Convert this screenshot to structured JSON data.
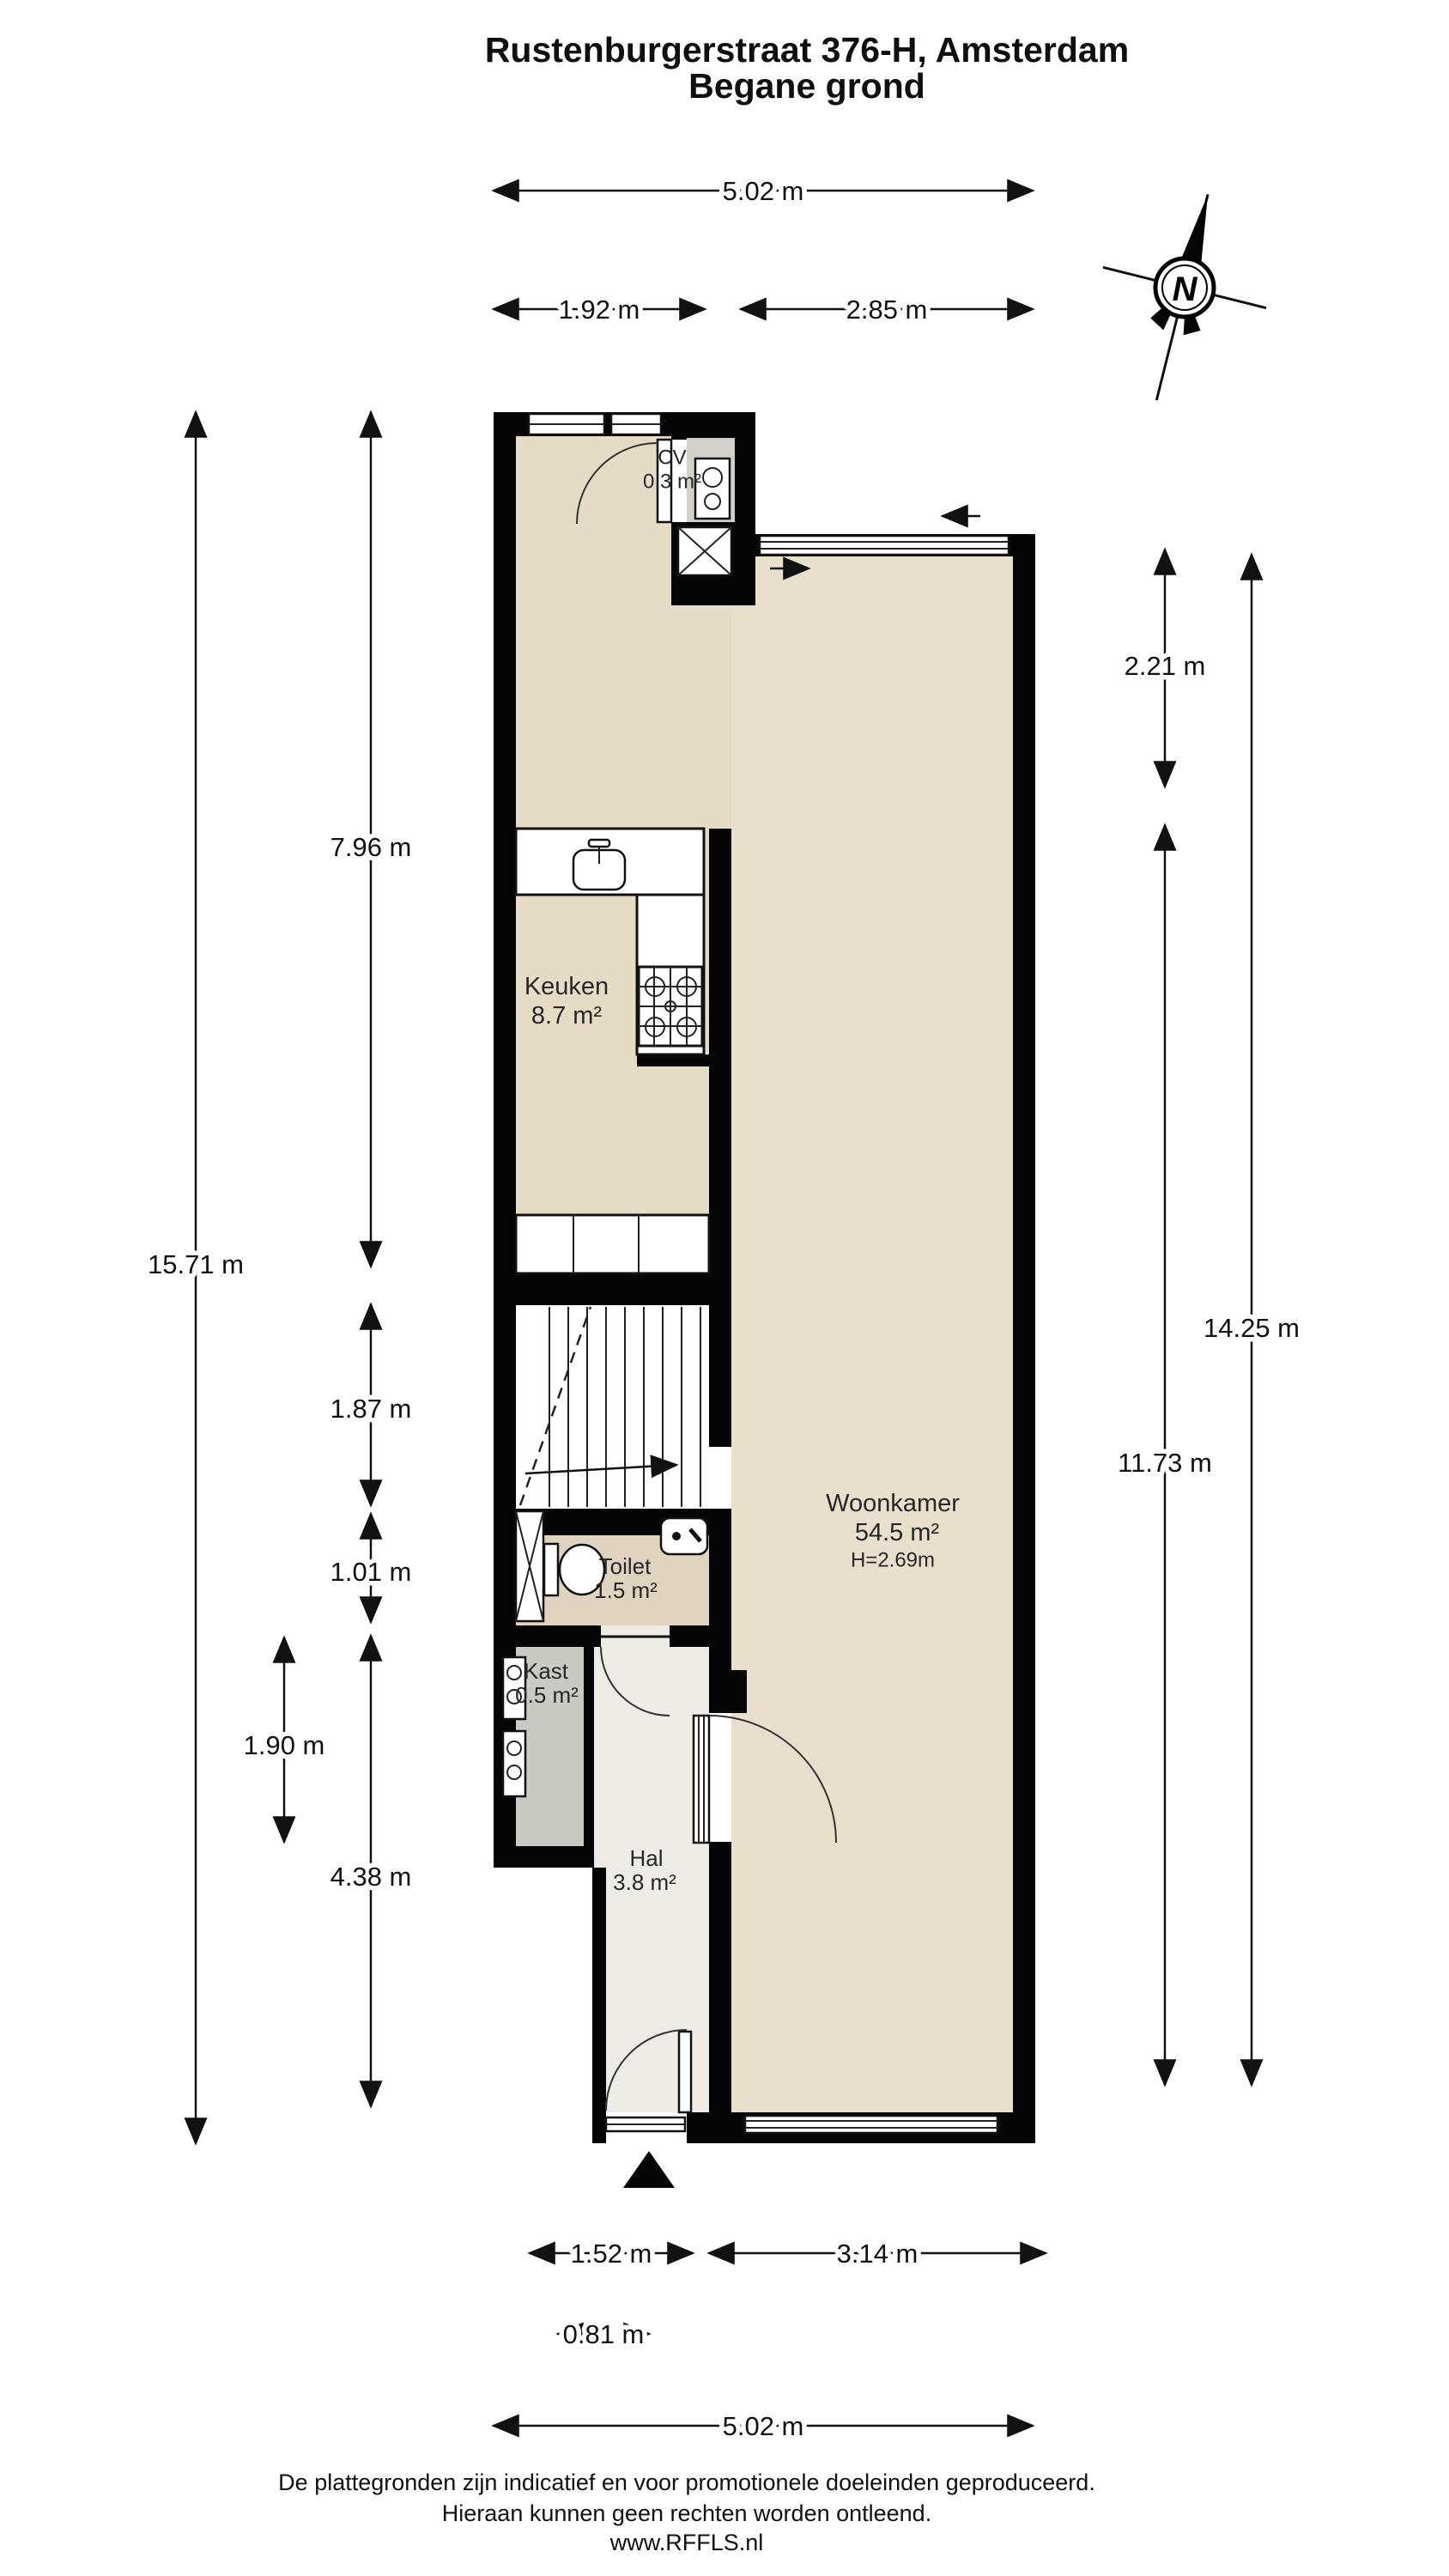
{
  "header": {
    "title_line1": "Rustenburgerstraat 376-H, Amsterdam",
    "title_line2": "Begane grond"
  },
  "compass": {
    "label": "N"
  },
  "rooms": {
    "cv": {
      "name": "CV",
      "area": "0.3 m²"
    },
    "keuken": {
      "name": "Keuken",
      "area": "8.7 m²"
    },
    "woonkamer": {
      "name": "Woonkamer",
      "area": "54.5 m²",
      "height": "H=2.69m"
    },
    "toilet": {
      "name": "Toilet",
      "area": "1.5 m²"
    },
    "kast": {
      "name": "Kast",
      "area": "0.5 m²"
    },
    "hal": {
      "name": "Hal",
      "area": "3.8 m²"
    }
  },
  "dimensions": {
    "top_total": "5.02 m",
    "top_left": "1.92 m",
    "top_right": "2.85 m",
    "left_total": "15.71 m",
    "left_upper": "7.96 m",
    "left_stairs": "1.87 m",
    "left_toilet": "1.01 m",
    "left_lower_outer": "1.90 m",
    "left_lower": "4.38 m",
    "right_upper": "2.21 m",
    "right_total": "14.25 m",
    "right_living": "11.73 m",
    "bottom_hal": "1.52 m",
    "bottom_living": "3.14 m",
    "bottom_door": "0.81 m",
    "bottom_total": "5.02 m"
  },
  "footer": {
    "line1": "De plattegronden zijn indicatief en voor promotionele doeleinden geproduceerd.",
    "line2": "Hieraan kunnen geen rechten worden ontleend.",
    "line3": "www.RFFLS.nl"
  },
  "colors": {
    "wall": "#050505",
    "floor_living": "#e8dfcd",
    "floor_kitchen": "#e6dcc6",
    "floor_toilet": "#e0d4bf",
    "floor_hall": "#efece5",
    "floor_closet": "#cbcac2",
    "cv_interior": "#d3d1c9"
  }
}
